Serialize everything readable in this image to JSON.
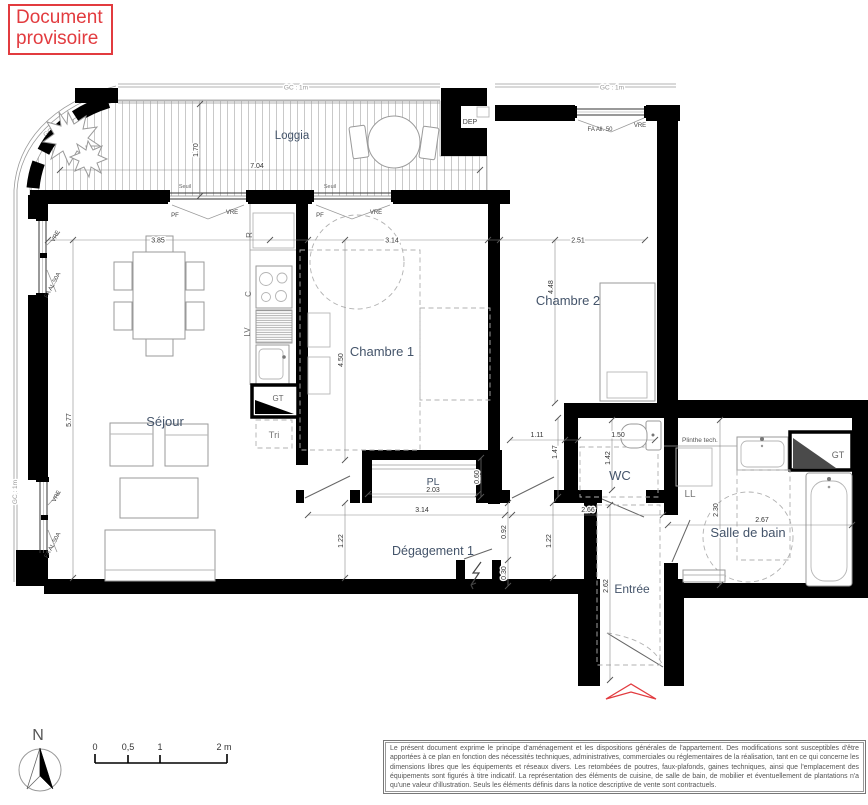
{
  "stamp": {
    "line1": "Document",
    "line2": "provisoire"
  },
  "rooms": {
    "loggia": "Loggia",
    "sejour": "Séjour",
    "chambre1": "Chambre 1",
    "chambre2": "Chambre 2",
    "wc": "WC",
    "salle_de_bain": "Salle de bain",
    "degagement": "Dégagement 1",
    "entree": "Entrée",
    "placard": "PL"
  },
  "fixtures": {
    "fridge": "R",
    "hob": "C",
    "dishwasher": "LV",
    "gt_kitchen": "GT",
    "gt_bath": "GT",
    "tri": "Tri",
    "washing_machine": "LL",
    "plinthe": "Plinthe tech.",
    "dep": "DEP"
  },
  "windows": {
    "seuil": "Seuil",
    "pf": "PF",
    "vre": "VRE",
    "fa_al_50a": "FA AL.50A",
    "fa_all_50": "FA All. 50",
    "gc_1m": "GC : 1m"
  },
  "dims": {
    "loggia_w": "7.04",
    "loggia_d": "1.70",
    "sejour_w": "3.85",
    "sejour_h": "5.77",
    "ch1_w": "3.14",
    "ch1_h": "4.50",
    "ch2_w": "2.51",
    "ch2_h": "4.48",
    "wc_top": "1.11",
    "wc_w": "1.50",
    "wc_h": "1.42",
    "wc_side": "1.47",
    "deg_w": "3.14",
    "deg_right": "2.66",
    "deg_h_left": "1.22",
    "deg_h_right": "1.22",
    "d_092": "0.92",
    "d_030": "0.30",
    "pl_w": "2.03",
    "pl_d": "0.60",
    "sdb_w": "2.67",
    "sdb_h": "2.30",
    "entree_h": "2.62"
  },
  "scale_bar": {
    "t0": "0",
    "t1": "0,5",
    "t2": "1",
    "t3": "2 m"
  },
  "compass": {
    "north": "N"
  },
  "legend": {
    "text": "Le présent document exprime le principe d'aménagement et les dispositions générales de l'appartement. Des modifications sont susceptibles d'être apportées à ce plan en fonction des nécessités techniques, administratives, commerciales ou réglementaires de la réalisation, tant en ce qui concerne les dimensions libres que les équipements et réseaux divers. Les retombées de poutres, faux-plafonds, gaines techniques, ainsi que l'emplacement des équipements sont figurés à titre indicatif. La représentation des éléments de cuisine, de salle de bain, de mobilier et éventuellement de plantations n'a qu'une valeur d'illustration. Seuls les éléments définis dans la notice descriptive de vente sont contractuels."
  },
  "colors": {
    "stamp_red": "#e23b3f",
    "wall": "#000000",
    "room_label": "#44546a"
  }
}
